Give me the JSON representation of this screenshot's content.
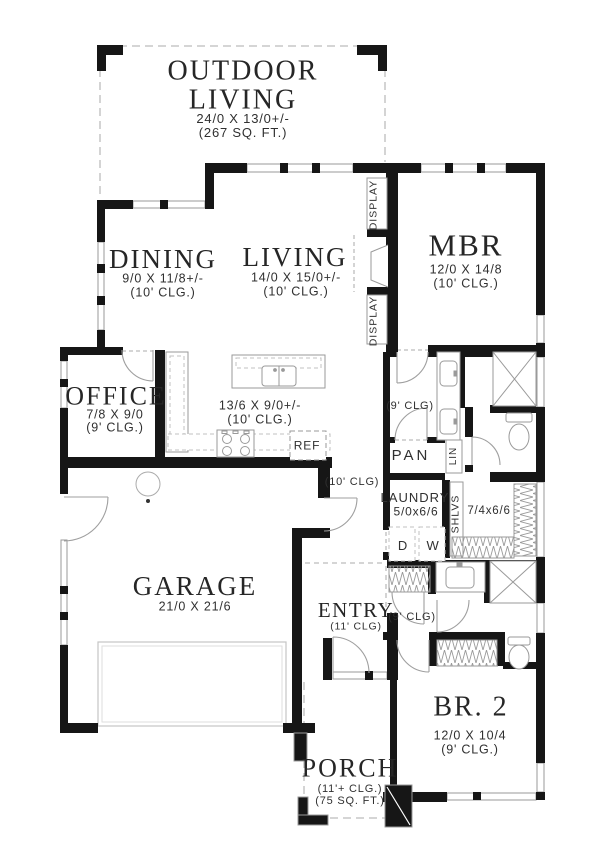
{
  "plan": {
    "rooms": {
      "outdoor_living": {
        "title": "OUTDOOR LIVING",
        "dims": "24/0 X 13/0+/-",
        "area": "(267 SQ. FT.)"
      },
      "dining": {
        "title": "DINING",
        "dims": "9/0 X 11/8+/-",
        "clg": "(10' CLG.)"
      },
      "living": {
        "title": "LIVING",
        "dims": "14/0 X 15/0+/-",
        "clg": "(10' CLG.)"
      },
      "mbr": {
        "title": "MBR",
        "dims": "12/0 X 14/8",
        "clg": "(10' CLG.)"
      },
      "office": {
        "title": "OFFICE",
        "dims": "7/8 X 9/0",
        "clg": "(9' CLG.)"
      },
      "kitchen": {
        "dims": "13/6 X 9/0+/-",
        "clg": "(10' CLG.)"
      },
      "garage": {
        "title": "GARAGE",
        "dims": "21/0 X 21/6"
      },
      "entry": {
        "title": "ENTRY",
        "clg": "(11' CLG)"
      },
      "laundry": {
        "title": "LAUNDRY",
        "dims": "5/0x6/6",
        "dryer": "D",
        "washer": "W"
      },
      "master_closet": {
        "dims": "7/4x6/6"
      },
      "br2": {
        "title": "BR. 2",
        "dims": "12/0 X 10/4",
        "clg": "(9' CLG.)"
      },
      "porch": {
        "title": "PORCH",
        "clg": "(11'+ CLG.)",
        "area": "(75 SQ. FT.)"
      }
    },
    "labels": {
      "pantry": "PAN",
      "linen": "LIN",
      "shelves": "SHLVS",
      "fridge": "REF",
      "display": "DISPLAY",
      "hall_upper_clg": "(9' CLG)",
      "hall_mid_clg": "(10' CLG)",
      "hall_lower_clg": "(9' CLG)"
    },
    "colors": {
      "wall": "#161616",
      "line": "#9a9a9a",
      "dash": "#bcbcbc"
    }
  }
}
